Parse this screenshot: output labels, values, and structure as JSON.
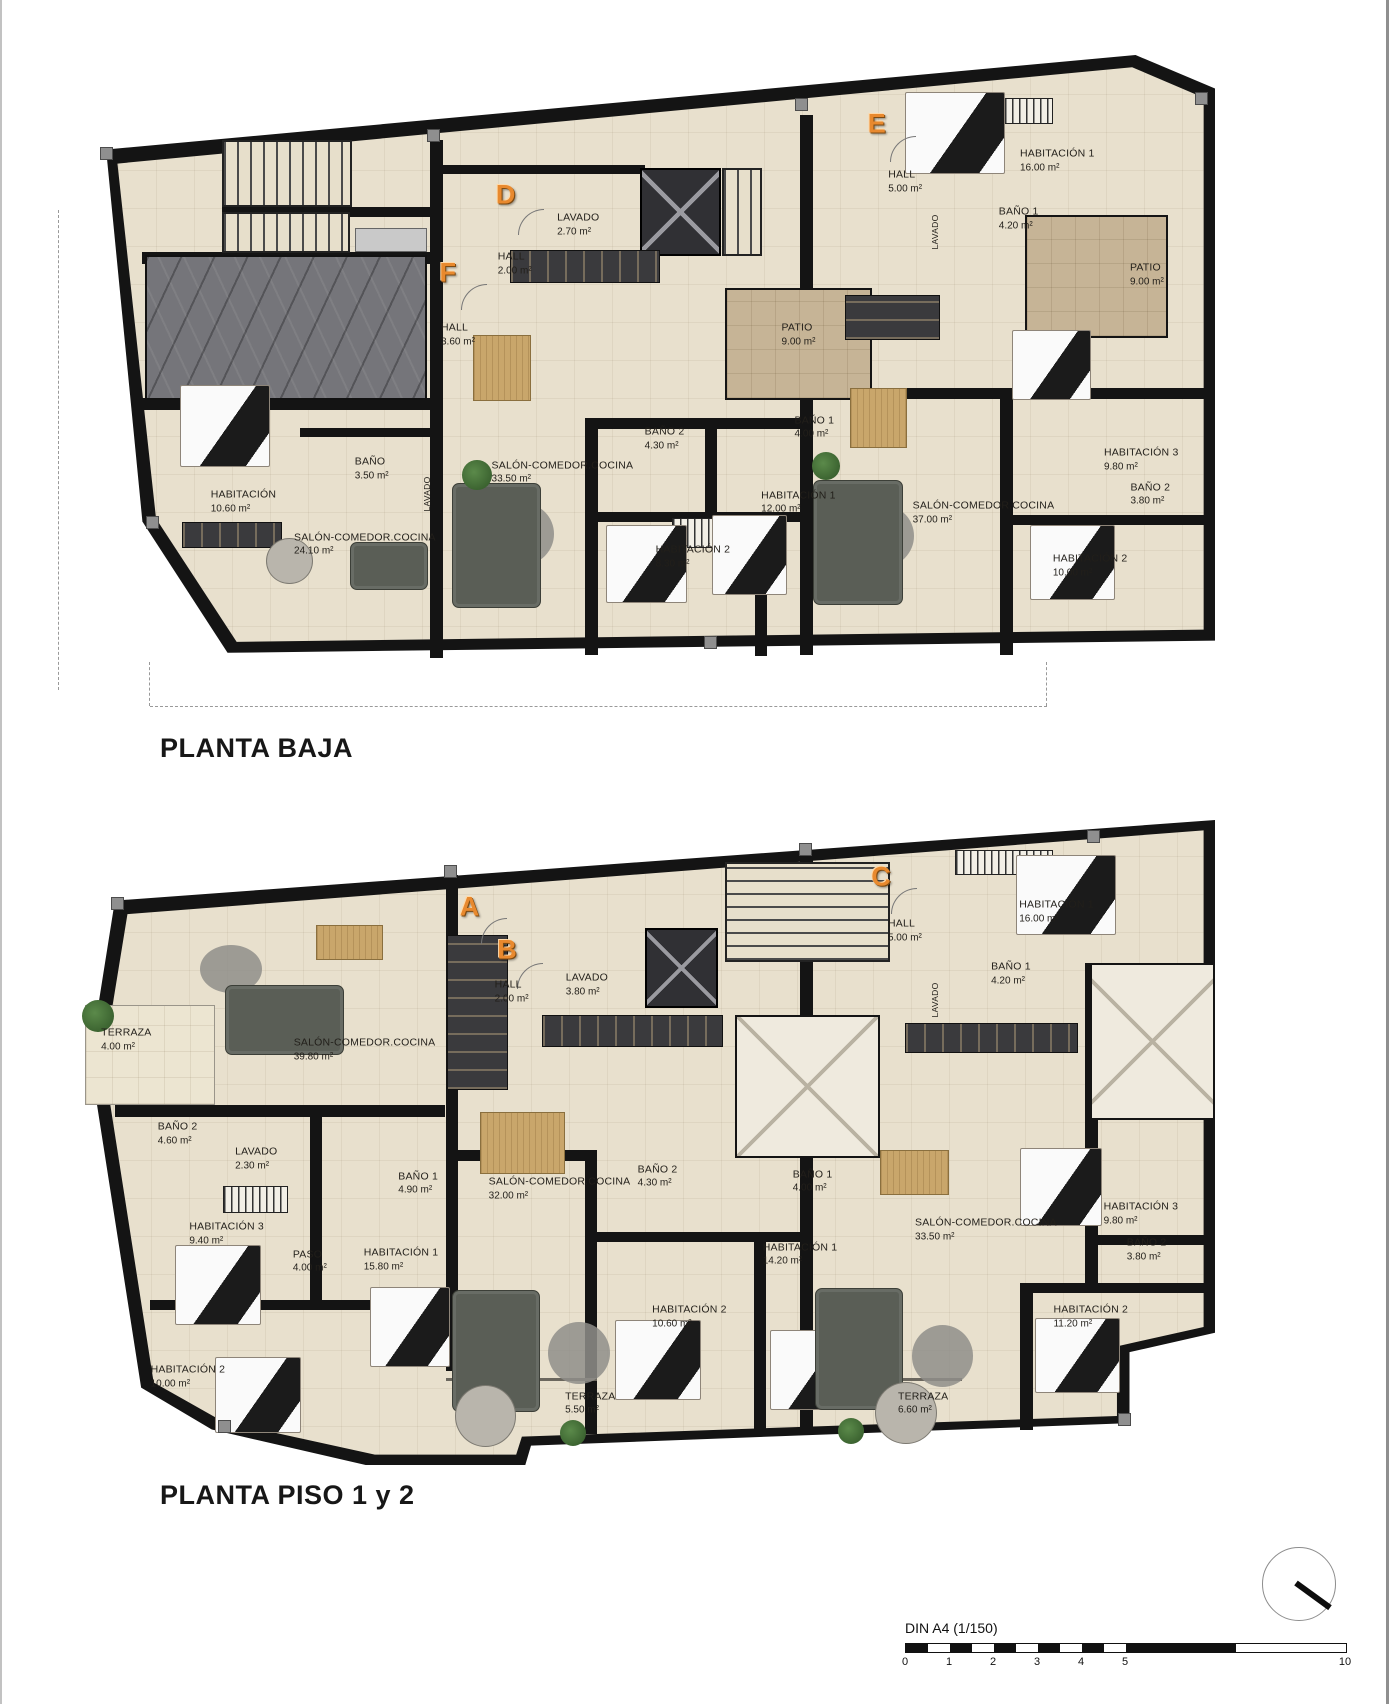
{
  "titles": {
    "plan1": "PLANTA BAJA",
    "plan2": "PLANTA PISO 1 y 2"
  },
  "footer": {
    "scale_label": "DIN A4 (1/150)",
    "ticks": [
      "0",
      "1",
      "2",
      "3",
      "4",
      "5",
      "10"
    ]
  },
  "colors": {
    "wall": "#141414",
    "floor": "#e8e0cd",
    "patio": "#c6b496",
    "garage": "#75757a",
    "badge_orange": "#e8892e"
  },
  "plan1": {
    "badges": [
      {
        "letter": "F",
        "x": 32.4,
        "y": 35.7
      },
      {
        "letter": "D",
        "x": 37.5,
        "y": 23.0
      },
      {
        "letter": "E",
        "x": 70.2,
        "y": 11.3
      }
    ],
    "rooms": [
      {
        "label": "HALL",
        "area": "3.60 m²",
        "x": 33.3,
        "y": 45.9
      },
      {
        "label": "LAVADO",
        "area": "2.70 m²",
        "x": 43.9,
        "y": 27.9
      },
      {
        "label": "HALL",
        "area": "2.00 m²",
        "x": 38.3,
        "y": 34.3
      },
      {
        "label": "HALL",
        "area": "5.00 m²",
        "x": 72.7,
        "y": 20.8
      },
      {
        "label": "HABITACIÓN 1",
        "area": "16.00 m²",
        "x": 86.1,
        "y": 17.4
      },
      {
        "label": "BAÑO 1",
        "area": "4.20 m²",
        "x": 82.7,
        "y": 26.9
      },
      {
        "label": "PATIO",
        "area": "9.00 m²",
        "x": 94.0,
        "y": 36.1
      },
      {
        "label": "PATIO",
        "area": "9.00 m²",
        "x": 63.3,
        "y": 45.9
      },
      {
        "label": "HABITACIÓN",
        "area": "10.60 m²",
        "x": 14.4,
        "y": 73.3
      },
      {
        "label": "BAÑO",
        "area": "3.50 m²",
        "x": 25.7,
        "y": 67.9
      },
      {
        "label": "SALÓN-COMEDOR.COCINA",
        "area": "24.10 m²",
        "x": 25.1,
        "y": 80.3
      },
      {
        "label": "SALÓN-COMEDOR.COCINA",
        "area": "33.50 m²",
        "x": 42.5,
        "y": 68.5
      },
      {
        "label": "BAÑO 2",
        "area": "4.30 m²",
        "x": 51.5,
        "y": 63.0
      },
      {
        "label": "BAÑO 1",
        "area": "4.00 m²",
        "x": 64.7,
        "y": 61.1
      },
      {
        "label": "HABITACIÓN 1",
        "area": "12.00 m²",
        "x": 63.3,
        "y": 73.4
      },
      {
        "label": "HABITACIÓN 2",
        "area": "8.30 m²",
        "x": 54.0,
        "y": 82.3
      },
      {
        "label": "SALÓN-COMEDOR.COCINA",
        "area": "37.00 m²",
        "x": 79.6,
        "y": 75.1
      },
      {
        "label": "HABITACIÓN 3",
        "area": "9.80 m²",
        "x": 93.5,
        "y": 66.4
      },
      {
        "label": "BAÑO 2",
        "area": "3.80 m²",
        "x": 94.3,
        "y": 72.1
      },
      {
        "label": "HABITACIÓN 2",
        "area": "10.00 m²",
        "x": 89.0,
        "y": 83.8
      }
    ],
    "vlabels": [
      {
        "label": "LAVADO",
        "x": 30.6,
        "y": 72.0
      },
      {
        "label": "LAVADO",
        "x": 75.3,
        "y": 29.0
      }
    ]
  },
  "plan2": {
    "badges": [
      {
        "letter": "A",
        "x": 34.6,
        "y": 13.5
      },
      {
        "letter": "B",
        "x": 37.9,
        "y": 20.2
      },
      {
        "letter": "C",
        "x": 70.7,
        "y": 8.8
      }
    ],
    "rooms": [
      {
        "label": "TERRAZA",
        "area": "4.00 m²",
        "x": 4.5,
        "y": 34.1
      },
      {
        "label": "SALÓN-COMEDOR.COCINA",
        "area": "39.80 m²",
        "x": 25.4,
        "y": 35.7
      },
      {
        "label": "BAÑO 2",
        "area": "4.60 m²",
        "x": 9.0,
        "y": 48.7
      },
      {
        "label": "LAVADO",
        "area": "2.30 m²",
        "x": 15.9,
        "y": 52.6
      },
      {
        "label": "HALL",
        "area": "2.00 m²",
        "x": 38.3,
        "y": 26.7
      },
      {
        "label": "LAVADO",
        "area": "3.80 m²",
        "x": 44.9,
        "y": 25.6
      },
      {
        "label": "HALL",
        "area": "5.00 m²",
        "x": 72.8,
        "y": 17.2
      },
      {
        "label": "HABITACIÓN 1",
        "area": "16.00 m²",
        "x": 86.1,
        "y": 14.3
      },
      {
        "label": "BAÑO 1",
        "area": "4.20 m²",
        "x": 82.1,
        "y": 23.9
      },
      {
        "label": "HABITACIÓN 3",
        "area": "9.40 m²",
        "x": 13.3,
        "y": 64.2
      },
      {
        "label": "PASO",
        "area": "4.00 m²",
        "x": 20.6,
        "y": 68.5
      },
      {
        "label": "BAÑO 1",
        "area": "4.90 m²",
        "x": 30.1,
        "y": 56.4
      },
      {
        "label": "HABITACIÓN 1",
        "area": "15.80 m²",
        "x": 28.6,
        "y": 68.2
      },
      {
        "label": "HABITACIÓN 2",
        "area": "10.00 m²",
        "x": 9.9,
        "y": 86.4
      },
      {
        "label": "SALÓN-COMEDOR.COCINA",
        "area": "32.00 m²",
        "x": 42.5,
        "y": 57.2
      },
      {
        "label": "BAÑO 2",
        "area": "4.30 m²",
        "x": 51.1,
        "y": 55.3
      },
      {
        "label": "BAÑO 1",
        "area": "4.00 m²",
        "x": 64.7,
        "y": 56.1
      },
      {
        "label": "HABITACIÓN 1",
        "area": "14.20 m²",
        "x": 63.6,
        "y": 67.4
      },
      {
        "label": "HABITACIÓN 2",
        "area": "10.60 m²",
        "x": 53.9,
        "y": 77.1
      },
      {
        "label": "TERRAZA",
        "area": "5.50 m²",
        "x": 45.2,
        "y": 90.5
      },
      {
        "label": "SALÓN-COMEDOR.COCINA",
        "area": "33.50 m²",
        "x": 79.9,
        "y": 63.6
      },
      {
        "label": "HABITACIÓN 3",
        "area": "9.80 m²",
        "x": 93.5,
        "y": 61.1
      },
      {
        "label": "BAÑO 2",
        "area": "3.80 m²",
        "x": 94.0,
        "y": 66.7
      },
      {
        "label": "HABITACIÓN 2",
        "area": "11.20 m²",
        "x": 89.1,
        "y": 77.1
      },
      {
        "label": "TERRAZA",
        "area": "6.60 m²",
        "x": 74.4,
        "y": 90.5
      }
    ],
    "vlabels": [
      {
        "label": "LAVADO",
        "x": 75.4,
        "y": 27.9
      }
    ]
  }
}
